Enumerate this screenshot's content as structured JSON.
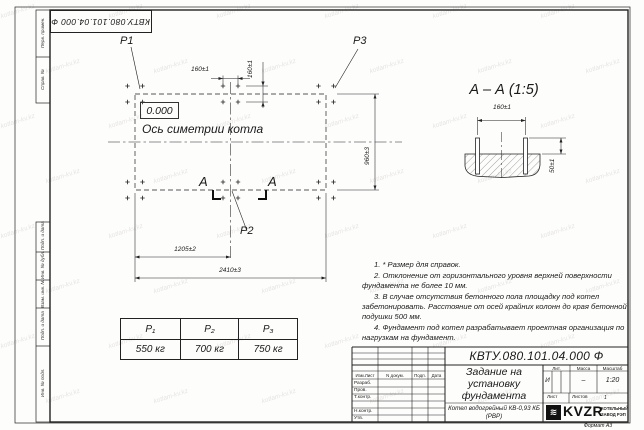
{
  "watermark": {
    "text": "kotlam-kv.kz"
  },
  "sidebar": {
    "top": [
      "Перв. примен.",
      "Справ. №"
    ],
    "bottom": [
      "Подп. и дата",
      "Инв. № дубл.",
      "Взам. инв. №",
      "Подп. и дата",
      "Инв. № подл."
    ]
  },
  "plan": {
    "labels": {
      "p1": "P1",
      "p2": "P2",
      "p3": "P3",
      "level": "0.000",
      "axis": "Ось симетрии котла"
    },
    "section_letter": "А",
    "dims": {
      "bolt_spacing_x": "160±1",
      "bolt_spacing_y": "160±1",
      "depth": "960±3",
      "half_length": "1205±2",
      "full_length": "2410±3"
    }
  },
  "section": {
    "title": "А – А (1:5)",
    "dims": {
      "bolt_spacing": "160±1",
      "bolt_height": "50±1"
    }
  },
  "notes": [
    "1. * Размер для справок.",
    "2. Отклонение от горизонтального уровня верхней поверхности фундамента не более 10 мм.",
    "3. В случае отсутствия бетонного пола площадку под котел забетонировать. Расстояние от осей крайних колонн до края бетонной подушки 500 мм.",
    "4. Фундамент под котел разрабатывает проектная организация по нагрузкам на фундамент."
  ],
  "load_table": {
    "headers": [
      "P₁",
      "P₂",
      "P₃"
    ],
    "values": [
      "550 кг",
      "700 кг",
      "750 кг"
    ]
  },
  "title_block": {
    "designation": "КВТУ.080.101.04.000 Ф",
    "doc_title": "Задание на установку фундамента",
    "product": "Котел водогрейный КВ-0,93 КБ (РВР)",
    "rev_headers": [
      "Изм.Лист",
      "N докум.",
      "Подп.",
      "Дата"
    ],
    "row_labels": [
      "Разраб.",
      "Пров.",
      "Т.контр.",
      "Н.контр.",
      "Утв."
    ],
    "lit_header": "Лит.",
    "mass_header": "Масса",
    "scale_header": "Масштаб",
    "lit": "И",
    "mass": "–",
    "scale": "1:20",
    "sheet_label": "Лист",
    "sheets_label": "Листов",
    "sheets_value": "1",
    "logo_text": "KVZR",
    "logo_glyph": "≋",
    "logo_caption": "КОТЕЛЬНЫЙ ЗАВОД РЭП",
    "format": "Формат А3"
  }
}
